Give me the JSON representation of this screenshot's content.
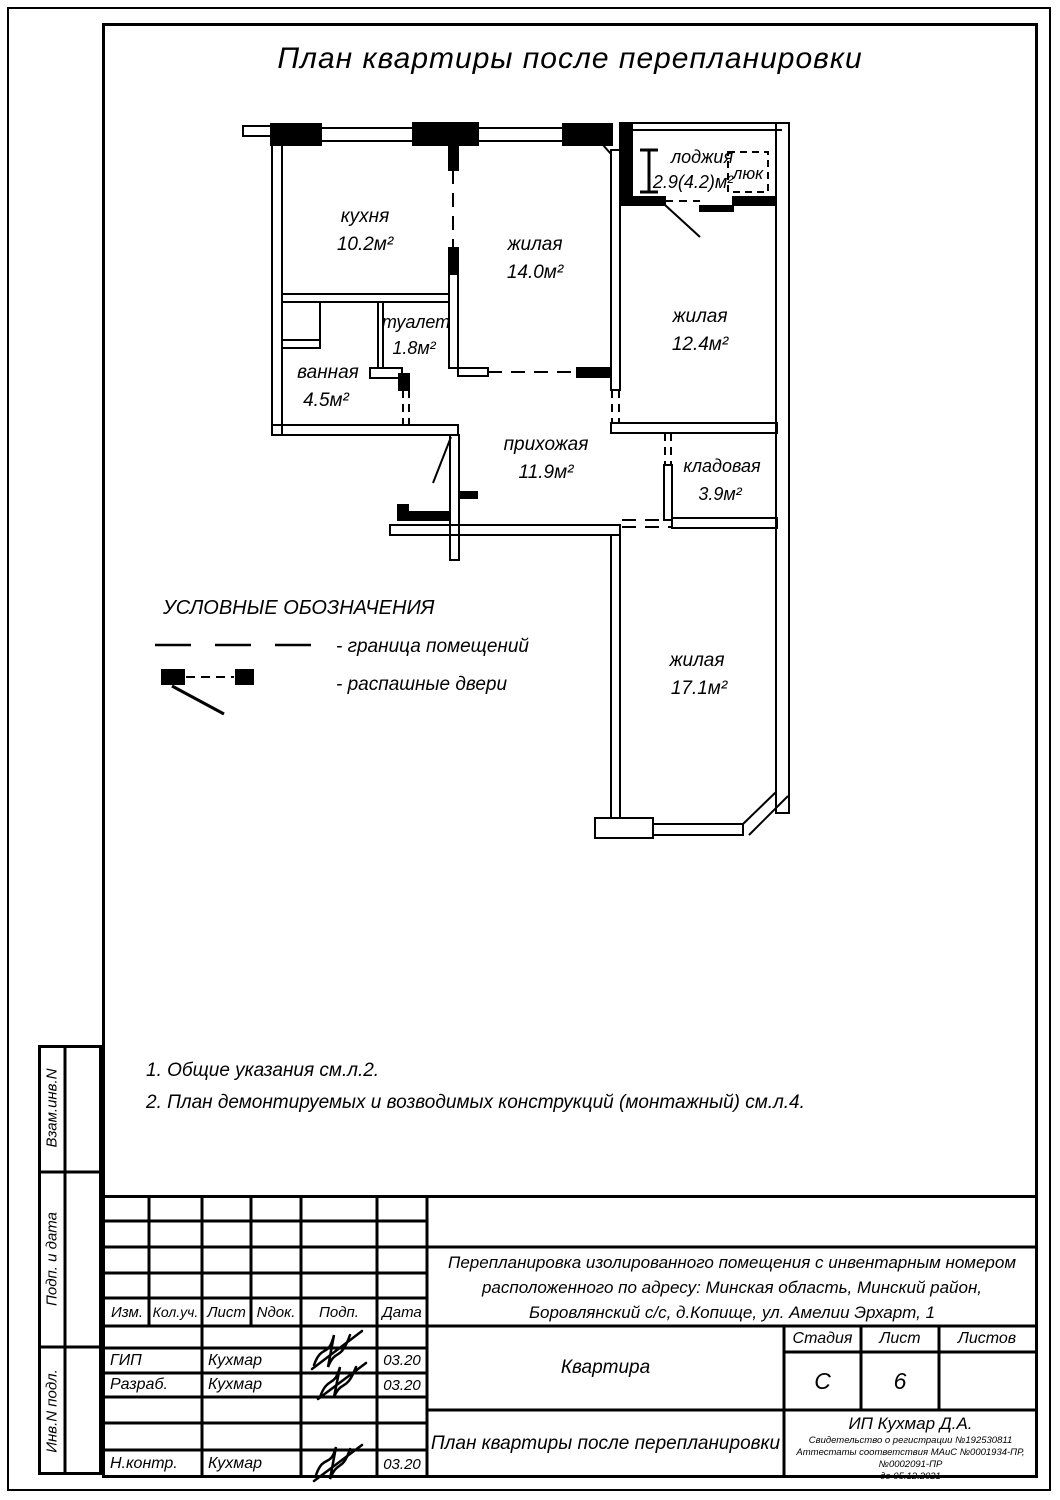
{
  "page": {
    "title": "План квартиры после перепланировки"
  },
  "plan": {
    "rooms": {
      "kitchen": {
        "name": "кухня",
        "area": "10.2м²"
      },
      "living1": {
        "name": "жилая",
        "area": "14.0м²"
      },
      "loggia": {
        "name": "лоджия",
        "area": "2.9(4.2)м²"
      },
      "hatch": {
        "name": "люк"
      },
      "living2": {
        "name": "жилая",
        "area": "12.4м²"
      },
      "toilet": {
        "name": "туалет",
        "area": "1.8м²"
      },
      "bath": {
        "name": "ванная",
        "area": "4.5м²"
      },
      "hall": {
        "name": "прихожая",
        "area": "11.9м²"
      },
      "storage": {
        "name": "кладовая",
        "area": "3.9м²"
      },
      "living3": {
        "name": "жилая",
        "area": "17.1м²"
      }
    }
  },
  "legend": {
    "title": "УСЛОВНЫЕ ОБОЗНАЧЕНИЯ",
    "items": [
      {
        "label": "- граница помещений"
      },
      {
        "label": "- распашные двери"
      }
    ]
  },
  "notes": [
    "1. Общие указания см.л.2.",
    "2. План демонтируемых и возводимых конструкций (монтажный) см.л.4."
  ],
  "sidebar": {
    "cells": [
      "Взам.инв.N",
      "Подп. и дата",
      "Инв.N подл."
    ]
  },
  "stamp": {
    "columns": [
      "Изм.",
      "Кол.уч.",
      "Лист",
      "Nдок.",
      "Подп.",
      "Дата"
    ],
    "rows": [
      {
        "role": "ГИП",
        "name": "Кухмар",
        "date": "03.20"
      },
      {
        "role": "Разраб.",
        "name": "Кухмар",
        "date": "03.20"
      },
      {
        "role": "Н.контр.",
        "name": "Кухмар",
        "date": "03.20"
      }
    ],
    "project": "Перепланировка изолированного помещения с инвентарным номером расположенного по адресу: Минская область, Минский район, Боровлянский с/с, д.Копище, ул. Амелии Эрхарт, 1",
    "object": "Квартира",
    "sheet_title": "План квартиры после перепланировки",
    "stage_label": "Стадия",
    "sheet_label": "Лист",
    "sheets_label": "Листов",
    "stage": "С",
    "sheet": "6",
    "sheets": "",
    "company": "ИП Кухмар Д.А.",
    "cert1": "Свидетельство о регистрации №192530811",
    "cert2": "Аттестаты соответствия МАиС №0001934-ПР, №0002091-ПР",
    "cert3": "до 05.12.2021"
  }
}
